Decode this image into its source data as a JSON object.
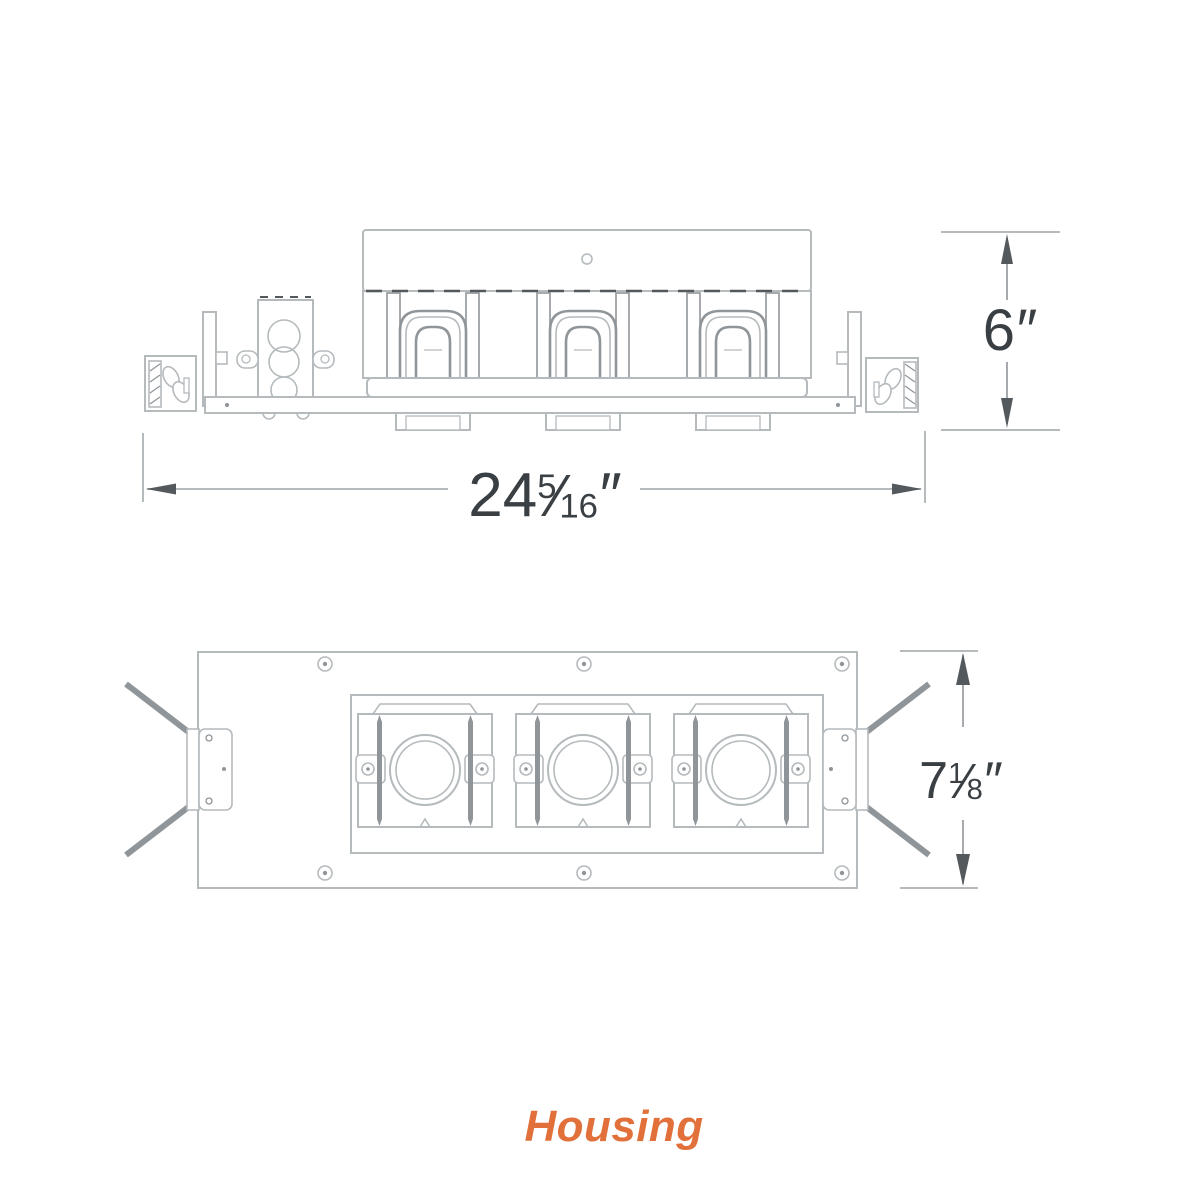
{
  "caption": {
    "label": "Housing"
  },
  "colors": {
    "accent": "#E2703A",
    "line_light": "#B5BABD",
    "line_medium": "#8F9599",
    "line_dark": "#54595D",
    "text_color": "#3A3F44",
    "bg": "#FFFFFF"
  },
  "views": {
    "elevation": {
      "width_dim": {
        "whole": "24",
        "numerator": "5",
        "denominator": "16",
        "slash": "⁄",
        "unit": "″"
      },
      "height_dim": {
        "whole": "6",
        "unit": "″"
      }
    },
    "plan": {
      "height_dim": {
        "whole": "7",
        "numerator": "1",
        "denominator": "8",
        "slash": "⁄",
        "unit": "″"
      }
    }
  }
}
